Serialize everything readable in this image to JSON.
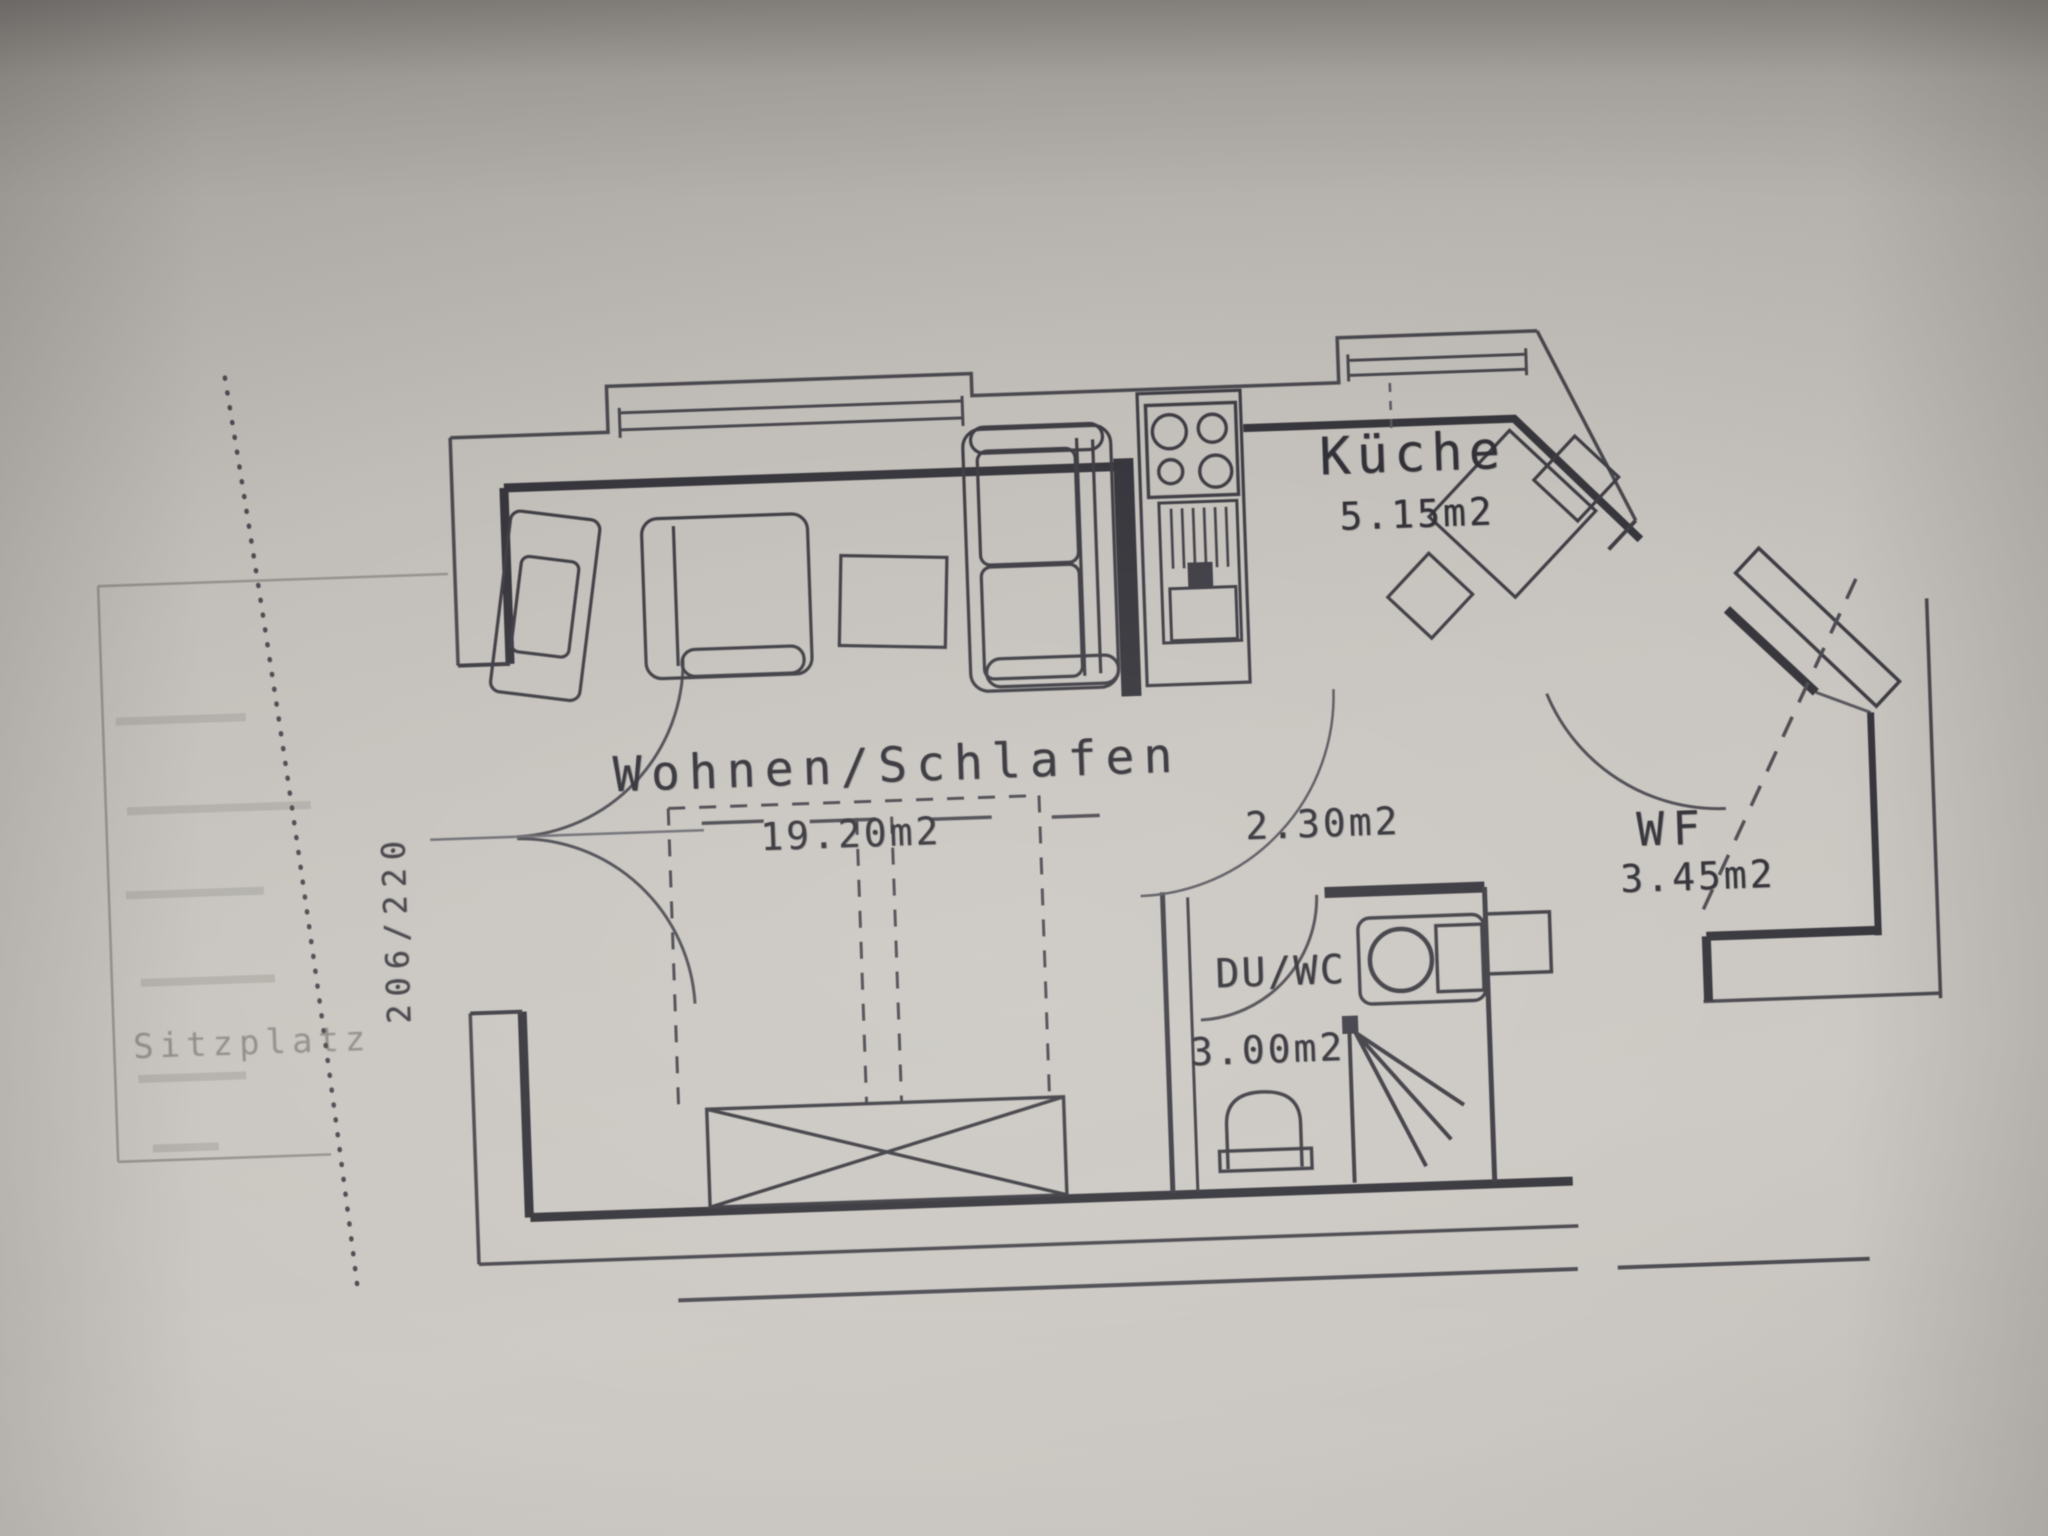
{
  "rooms": {
    "living": {
      "label": "Wohnen/Schlafen",
      "area": "19.20m2"
    },
    "kitchen": {
      "label": "Küche",
      "area": "5.15m2"
    },
    "hallway": {
      "area": "2.30m2"
    },
    "bathroom": {
      "label": "DU/WC",
      "area": "3.00m2"
    },
    "entry": {
      "label": "WF",
      "area": "3.45m2"
    }
  },
  "outdoor": {
    "terrace_label": "Sitzplatz"
  },
  "dimensions": {
    "patio_door": "206/220"
  },
  "colors": {
    "paper": "#c6c2bd",
    "ink": "#36353b"
  }
}
